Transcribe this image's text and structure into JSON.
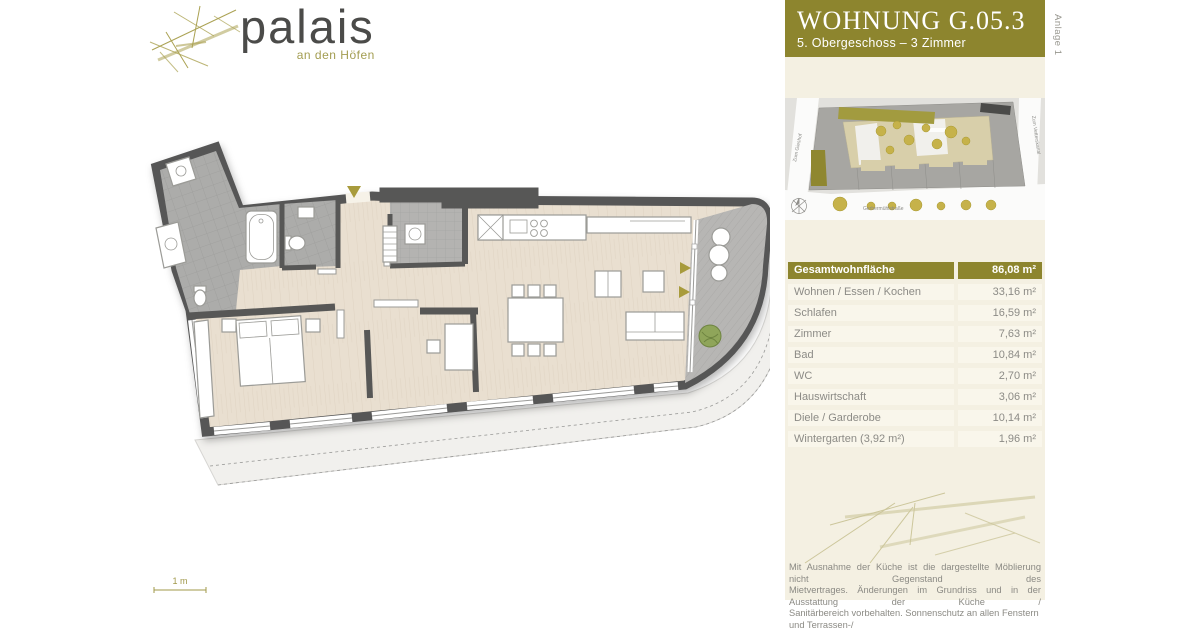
{
  "logo": {
    "name": "palais",
    "tagline": "an den Höfen"
  },
  "title_block": {
    "title": "WOHNUNG  G.05.3",
    "subtitle": "5. Obergeschoss – 3 Zimmer"
  },
  "annex_label": "Anlage 1",
  "site_plan": {
    "street_bottom": "Gerbermühlstraße",
    "street_left": "Zum Gieshof",
    "street_right": "Zum Vetterskanal"
  },
  "area_table": {
    "header": {
      "label": "Gesamtwohnfläche",
      "value": "86,08 m²"
    },
    "rows": [
      {
        "label": "Wohnen / Essen / Kochen",
        "value": "33,16 m²"
      },
      {
        "label": "Schlafen",
        "value": "16,59 m²"
      },
      {
        "label": "Zimmer",
        "value": "7,63 m²"
      },
      {
        "label": "Bad",
        "value": "10,84 m²"
      },
      {
        "label": "WC",
        "value": "2,70 m²"
      },
      {
        "label": "Hauswirtschaft",
        "value": "3,06 m²"
      },
      {
        "label": "Diele / Garderobe",
        "value": "10,14 m²"
      },
      {
        "label": "Wintergarten (3,92 m²)",
        "value": "1,96 m²"
      }
    ]
  },
  "scale_bar": {
    "label": "1 m"
  },
  "disclaimer_lines": [
    "Mit Ausnahme der Küche ist die dargestellte Möblierung nicht Gegenstand des",
    "Mietvertrages. Änderungen im Grundriss und in der Ausstattung der Küche /",
    "Sanitärbereich vorbehalten. Sonnenschutz an allen Fenstern und Terrassen-/"
  ],
  "colors": {
    "accent_olive": "#8d852e",
    "logo_olive": "#a39d51",
    "wall_gray": "#575756",
    "wood_floor": "#e9dfd0",
    "tile_gray": "#acacaa",
    "panel_cream": "#f4f0e2",
    "tree_gold": "#c6b24a",
    "text_gray": "#8c8b86"
  }
}
